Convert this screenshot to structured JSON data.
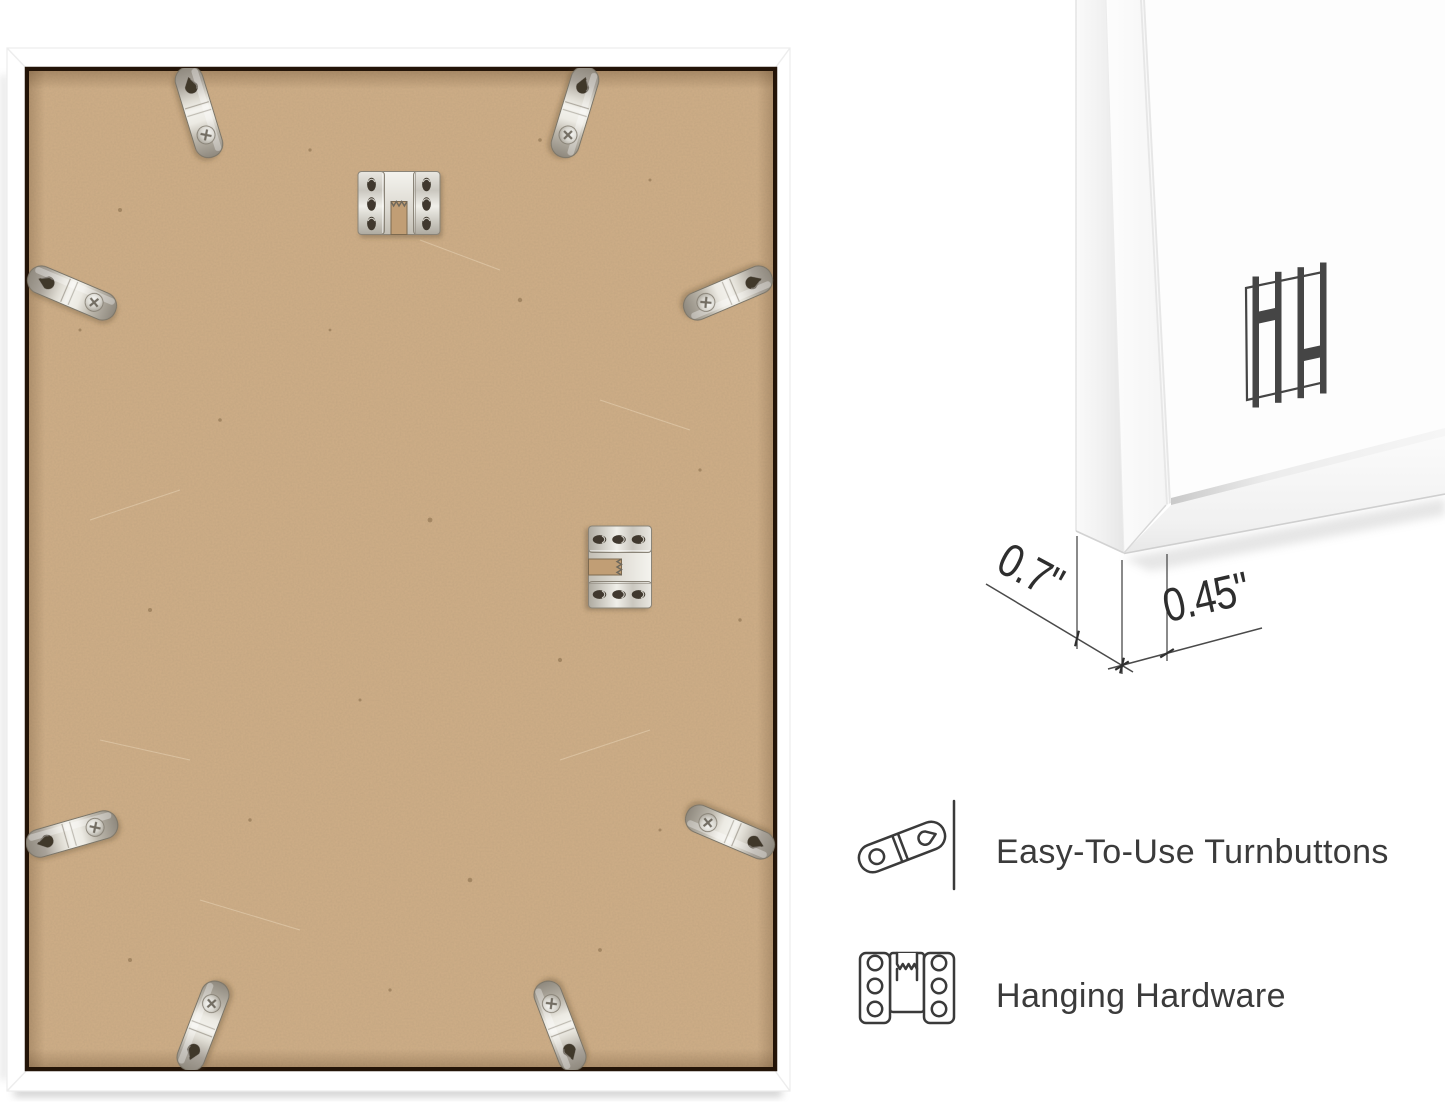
{
  "page": {
    "kind": "product-infographic",
    "subject": "Back view of white picture frame with corner detail and feature callouts"
  },
  "photo": {
    "description": "Back of frame: white moulding border, tan MDF backing board",
    "turnbutton_count": 8,
    "hanging_hardware_count": 2
  },
  "corner_detail": {
    "logo_icon": "hh-monogram-logo",
    "dimensions": [
      {
        "id": "depth",
        "label": "0.7\""
      },
      {
        "id": "face",
        "label": "0.45\""
      }
    ]
  },
  "features": [
    {
      "icon": "turnbutton-icon",
      "label": "Easy-To-Use Turnbuttons"
    },
    {
      "icon": "hanging-hardware-icon",
      "label": "Hanging Hardware"
    }
  ],
  "colors": {
    "background": "#ffffff",
    "frame_white": "#ffffff",
    "backing_tan": "#cfae87",
    "backing_speck": "#8a6f4e",
    "gap_dark": "#231408",
    "metal_light": "#f2f1ec",
    "metal_dark": "#8f897e",
    "dimension_line": "#4a4a4a",
    "text": "#3b3b3b",
    "logo": "#454545"
  }
}
